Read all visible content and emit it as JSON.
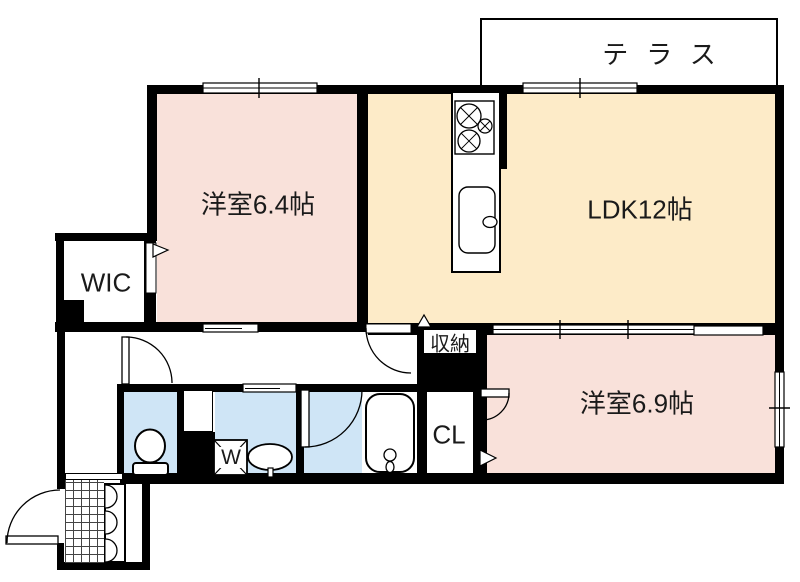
{
  "floorplan": {
    "title": "apartment-floor-plan",
    "labels": {
      "terrace": "テラス",
      "bedroom1": "洋室6.4帖",
      "ldk": "LDK12帖",
      "wic": "WIC",
      "storage": "収納",
      "bedroom2": "洋室6.9帖",
      "closet": "CL",
      "washer": "W"
    },
    "colors": {
      "bedroom_fill": "#f9e1da",
      "ldk_fill": "#fdebc8",
      "wet_area_fill": "#cfe5f6",
      "wall_color": "#000000"
    }
  }
}
